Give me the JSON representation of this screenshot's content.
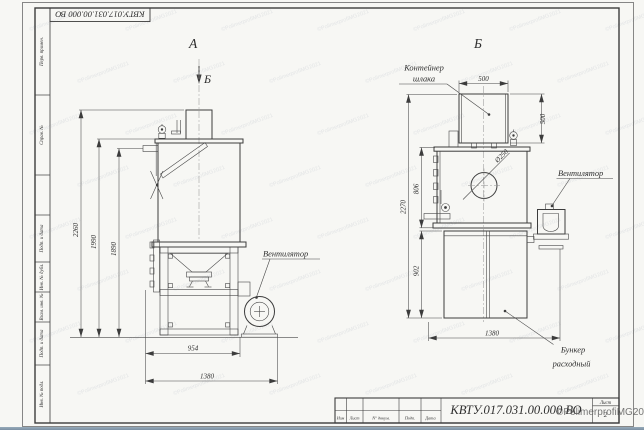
{
  "sheet": {
    "code": "КВТУ.017.031.00.000  ВО",
    "stamp": "КВТУ.017.031.00.000  ВО",
    "sheet_word": "Лист",
    "sheet_number": "2",
    "title_columns": [
      "Изм",
      "Лист",
      "N° докум.",
      "Подп.",
      "Дата"
    ],
    "margin_fields": [
      "Перв. примен.",
      "Справ. №",
      "Подп. и дата",
      "Инв. № дубл.",
      "Взам. инв. №",
      "Подп. и дата",
      "Инв. № подл."
    ],
    "watermark_corner": "©PolimerprofiMG2021",
    "watermark_tile": "©PolimerprofiMG2021"
  },
  "views": {
    "left": {
      "label": "А",
      "section_mark": "Б",
      "fan_label": "Вентилятор",
      "dims": {
        "h_total": "2260",
        "h_body": "1990",
        "h_pipe": "1890",
        "w_stand": "954",
        "w_total": "1380"
      }
    },
    "right": {
      "label": "Б",
      "container_line1": "Контейнер",
      "container_line2": "шлака",
      "fan_label": "Вентилятор",
      "hopper_line1": "Бункер",
      "hopper_line2": "расходный",
      "dims": {
        "w_top": "500",
        "h_container": "500",
        "h_total": "2270",
        "h_upper": "806",
        "h_lower": "902",
        "w_bottom": "1380",
        "hole": "Ø250"
      }
    }
  }
}
